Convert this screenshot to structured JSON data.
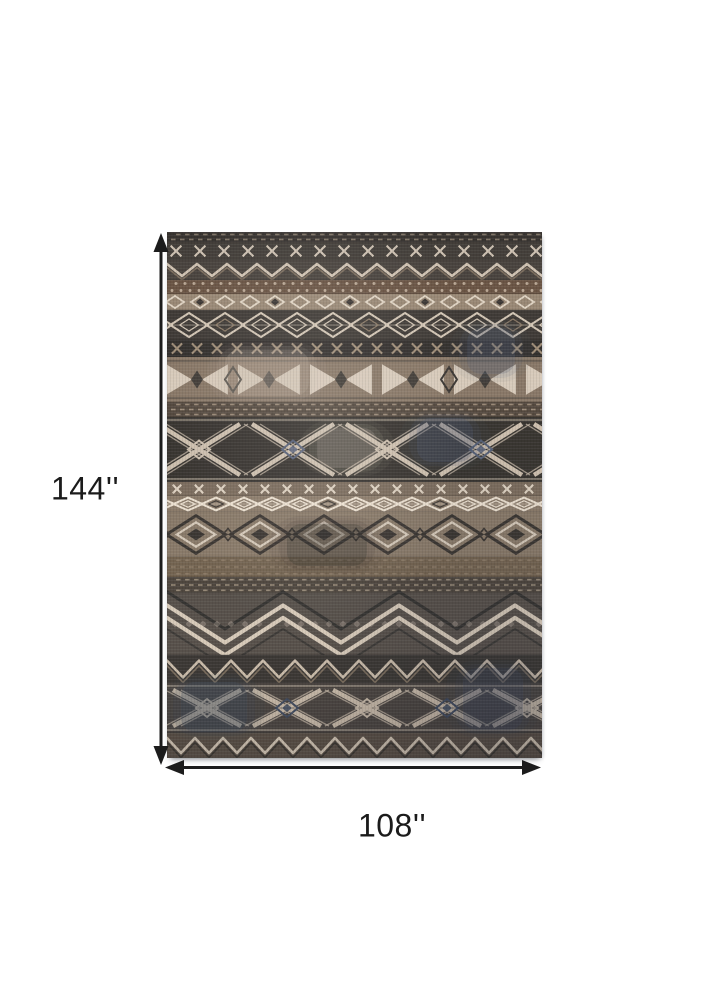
{
  "image": {
    "description": "Area rug product photo annotated with dimension arrows",
    "background": "#ffffff"
  },
  "dimensions": {
    "height_label": "144''",
    "width_label": "108''",
    "arrow_color": "#1c1c1c",
    "label_color": "#1b1b1b"
  },
  "rug": {
    "style": "southwestern tribal banded pattern",
    "palette": {
      "charcoal": "#38342f",
      "taupe": "#8a7866",
      "cream": "#d8cab8",
      "brown": "#6b5443",
      "blue_gray": "#4a5a74"
    },
    "bands": [
      {
        "t": "ticks",
        "h": 10,
        "bg": "#3a3531",
        "fg": "#b7a58f"
      },
      {
        "t": "xrow",
        "h": 18,
        "bg": "#45403a",
        "fg": "#d9cbba",
        "p": 24
      },
      {
        "t": "zigzag",
        "h": 20,
        "bg": "#4a443e",
        "fg": "#d6c7b5",
        "accent": "#8c7a66",
        "p": 30
      },
      {
        "t": "dots",
        "h": 14,
        "bg": "#6b5443",
        "fg": "#c9b6a1"
      },
      {
        "t": "diamondRow",
        "h": 16,
        "bg": "#9a8874",
        "fg": "#e3d6c4",
        "accent": "#3c3733",
        "s": 9
      },
      {
        "t": "diamondChain",
        "h": 30,
        "bg": "#3f3a35",
        "fg": "#d5c7b5",
        "accent": "#8c7a66",
        "p": 36
      },
      {
        "t": "xrow",
        "h": 17,
        "bg": "#332f2c",
        "fg": "#a08d77",
        "p": 20
      },
      {
        "t": "bowtie",
        "h": 45,
        "bg": "#8a7866",
        "fg": "#ddd0bf",
        "accent": "#3a3632",
        "p": 72
      },
      {
        "t": "ticks",
        "h": 15,
        "bg": "#55493e",
        "fg": "#c2ae96"
      },
      {
        "t": "lattice",
        "h": 65,
        "bg": "#38342f",
        "fg": "#cfc0ae",
        "accent": "#56617a",
        "p": 94
      },
      {
        "t": "xrow",
        "h": 14,
        "bg": "#7c6c5c",
        "fg": "#e0d3c1",
        "p": 22
      },
      {
        "t": "diamondChain",
        "h": 16,
        "bg": "#8d7c6a",
        "fg": "#efe3d2",
        "accent": "#403a34",
        "p": 28
      },
      {
        "t": "concentric",
        "h": 45,
        "bg": "#8a7a68",
        "fg": "#3b3631",
        "accent": "#d8cbba",
        "p": 64
      },
      {
        "t": "ticks",
        "h": 20,
        "bg": "#74634f",
        "fg": "#9b8871"
      },
      {
        "t": "ticks",
        "h": 16,
        "bg": "#4e463d",
        "fg": "#bfae97"
      },
      {
        "t": "chevron",
        "h": 62,
        "bg": "#57504a",
        "fg": "#d9cbb9",
        "accent": "#32302d",
        "p": 116
      },
      {
        "t": "zigzag",
        "h": 28,
        "bg": "#3b3733",
        "fg": "#cbbca9",
        "accent": "#8c7a66",
        "p": 32
      },
      {
        "t": "lattice",
        "h": 50,
        "bg": "#4a443f",
        "fg": "#c6b7a5",
        "accent": "#3f4a5e",
        "p": 80
      },
      {
        "t": "zigzag",
        "h": 25,
        "bg": "#5a4f44",
        "fg": "#d3c5b2",
        "accent": "#332f2b",
        "p": 28
      }
    ],
    "patches": [
      {
        "x": 300,
        "y": 96,
        "w": 48,
        "h": 46,
        "c": "#55627b",
        "o": 0.22
      },
      {
        "x": 250,
        "y": 186,
        "w": 56,
        "h": 44,
        "c": "#4a5872",
        "o": 0.25
      },
      {
        "x": 150,
        "y": 196,
        "w": 60,
        "h": 40,
        "c": "#d8cab8",
        "o": 0.18
      },
      {
        "x": 58,
        "y": 118,
        "w": 84,
        "h": 46,
        "c": "#cdbfae",
        "o": 0.18
      },
      {
        "x": 120,
        "y": 292,
        "w": 80,
        "h": 42,
        "c": "#26231f",
        "o": 0.22
      },
      {
        "x": 14,
        "y": 450,
        "w": 66,
        "h": 50,
        "c": "#3c4a60",
        "o": 0.25
      },
      {
        "x": 296,
        "y": 436,
        "w": 60,
        "h": 62,
        "c": "#3f4d64",
        "o": 0.24
      }
    ]
  }
}
